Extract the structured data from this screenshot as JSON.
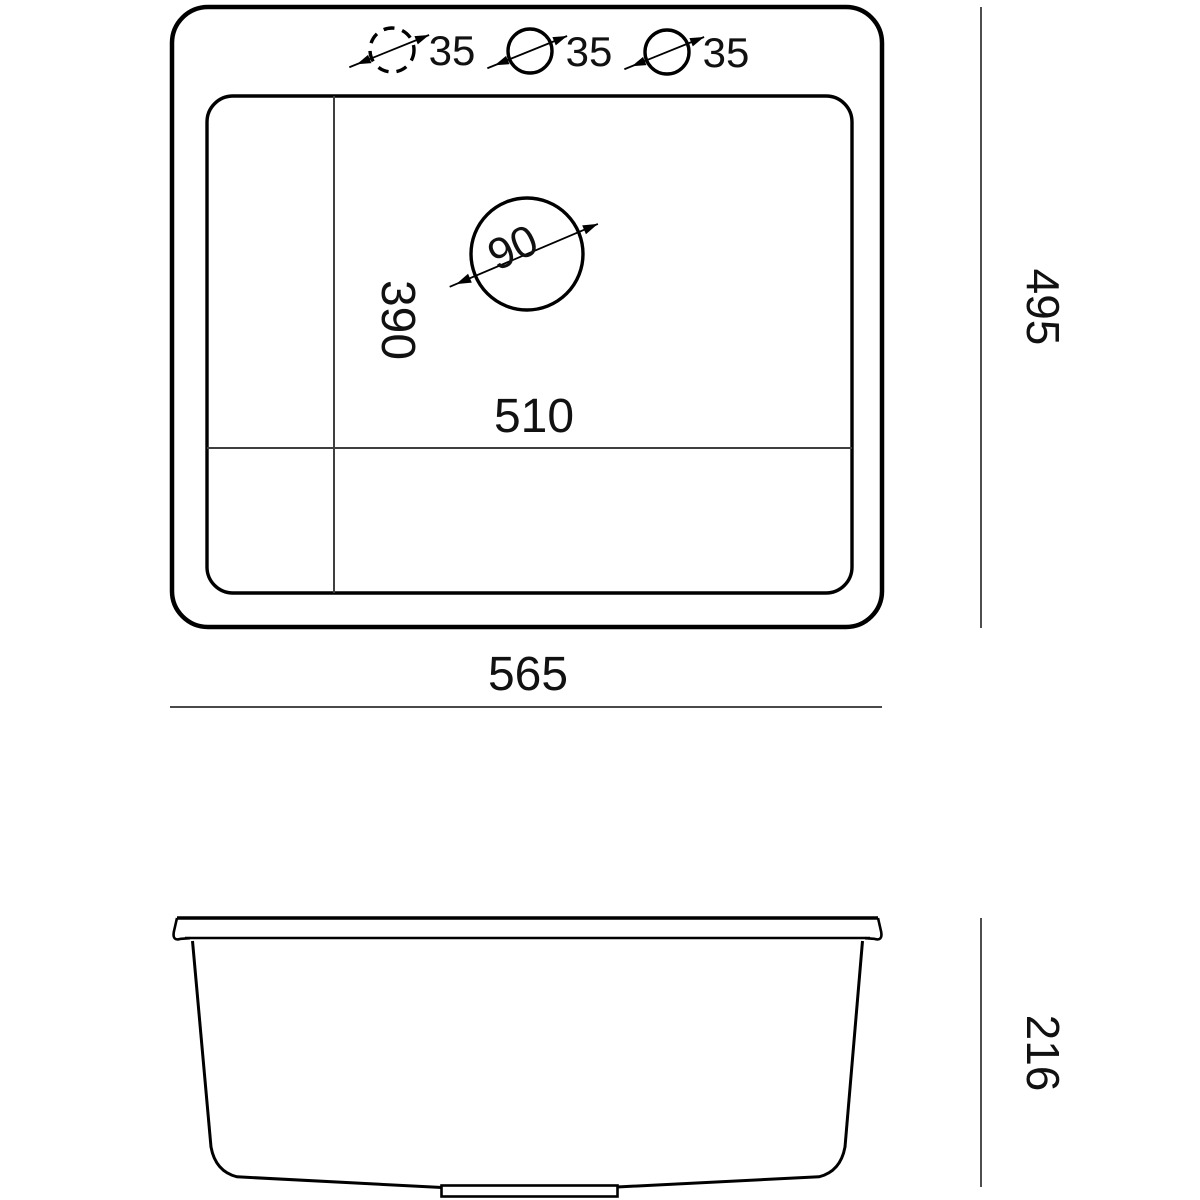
{
  "drawing_title": "sink-dimension-drawing",
  "colors": {
    "background": "#ffffff",
    "outline": "#000000",
    "divider_line": "#3f3f3f",
    "dimension_line": "#2f2f2f",
    "text": "#111111"
  },
  "top_view": {
    "faucet_holes": [
      {
        "label": "35",
        "style": "dashed"
      },
      {
        "label": "35",
        "style": "solid"
      },
      {
        "label": "35",
        "style": "solid"
      }
    ],
    "drain": {
      "label": "90"
    },
    "inner_width_label": "510",
    "inner_depth_label": "390",
    "overall_width_label": "565",
    "overall_depth_label": "495"
  },
  "side_view": {
    "height_label": "216"
  }
}
